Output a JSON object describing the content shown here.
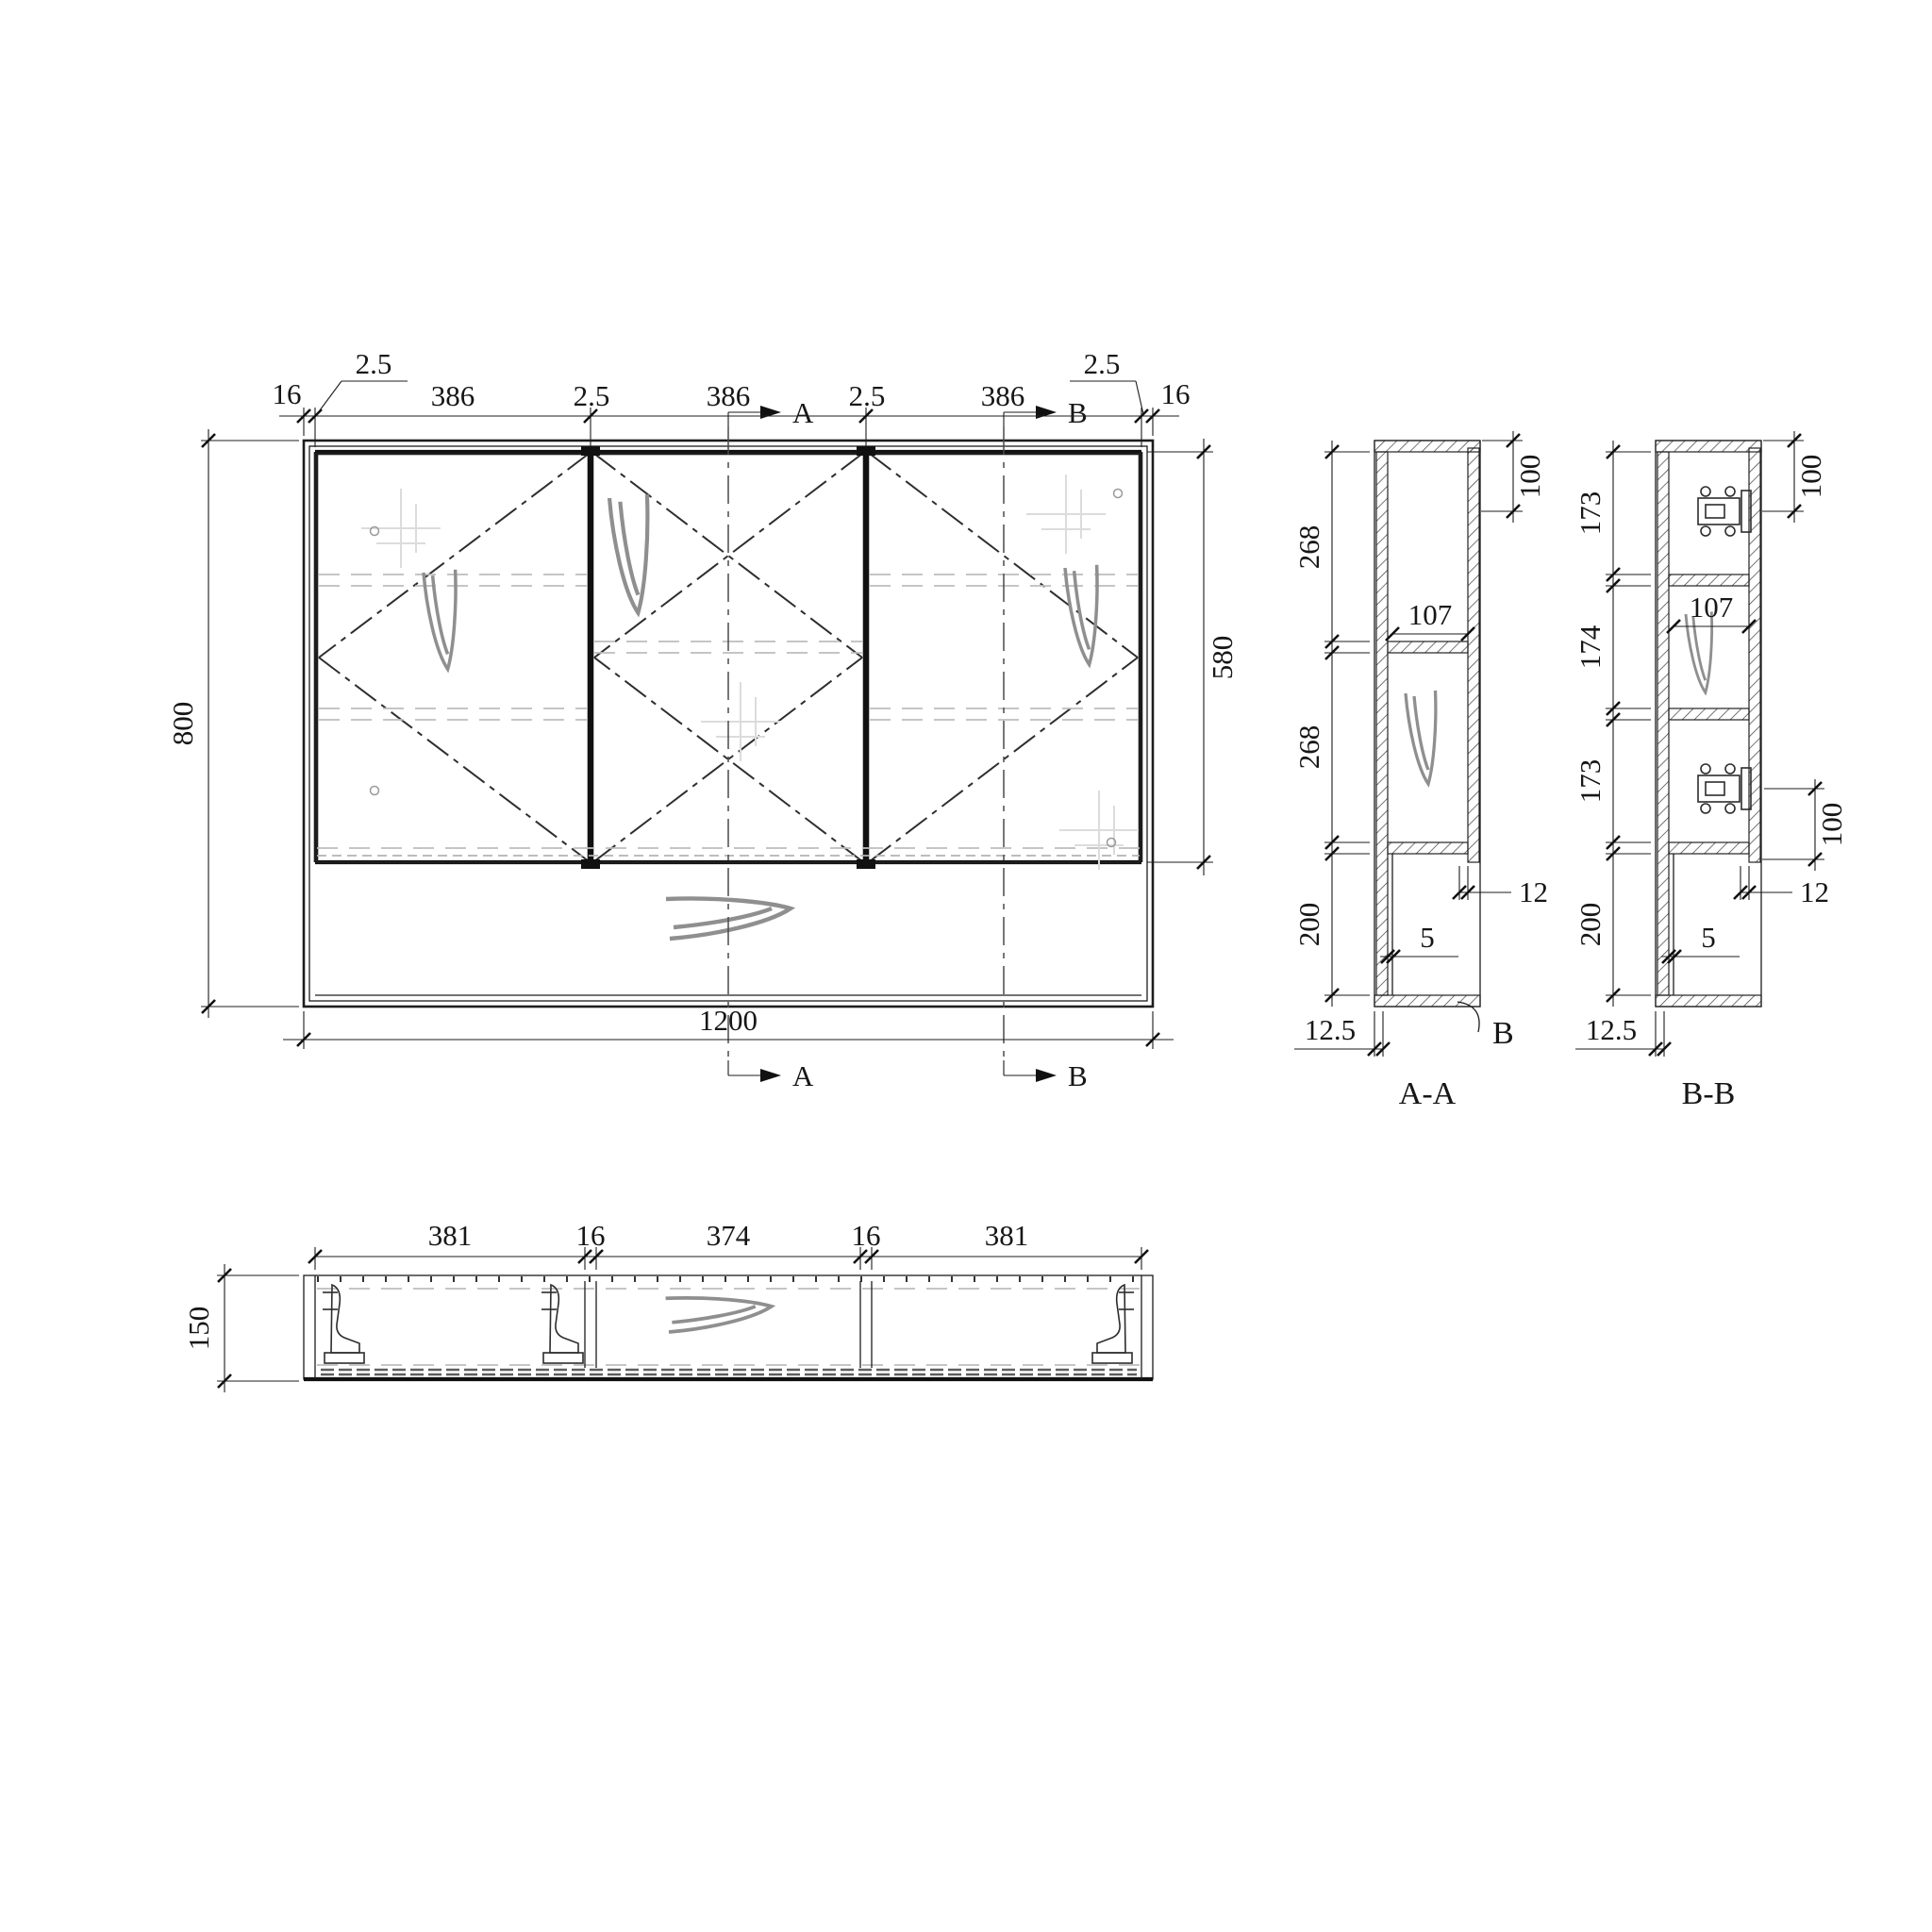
{
  "front": {
    "dims_top": [
      "16",
      "2.5",
      "386",
      "2.5",
      "386",
      "2.5",
      "386",
      "2.5",
      "16"
    ],
    "dim_left": "800",
    "dim_right": "580",
    "dim_bottom": "1200",
    "marker_a": "A",
    "marker_b": "B"
  },
  "section_aa": {
    "label": "A-A",
    "dims_left": [
      "268",
      "268",
      "200"
    ],
    "dim_top": "100",
    "dim_width": "107",
    "dim_reveal": "12",
    "dim_back": "5",
    "dim_bottom": "12.5",
    "detail": "B"
  },
  "section_bb": {
    "label": "B-B",
    "dims_left": [
      "173",
      "174",
      "173",
      "200"
    ],
    "dim_top": "100",
    "dim_width": "107",
    "dim_mid": "100",
    "dim_reveal": "12",
    "dim_back": "5",
    "dim_bottom": "12.5"
  },
  "plan": {
    "dims_top": [
      "381",
      "16",
      "374",
      "16",
      "381"
    ],
    "dim_left": "150"
  }
}
